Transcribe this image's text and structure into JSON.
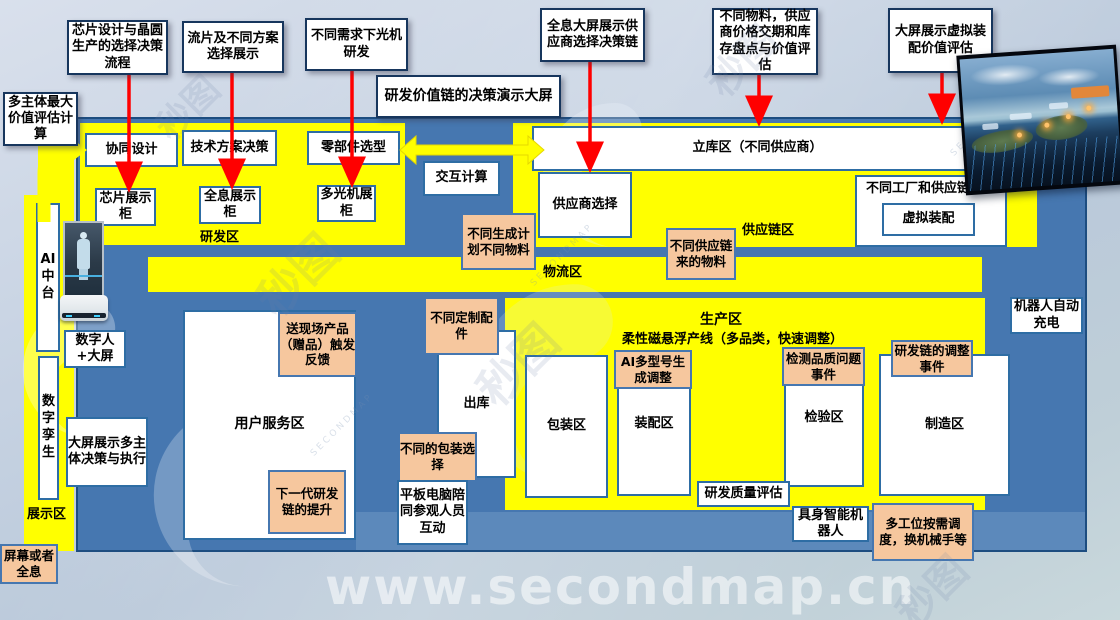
{
  "labels": {
    "callout_chip": "芯片设计与晶圆生产的选择决策流程",
    "callout_tapeout": "流片及不同方案选择展示",
    "callout_optical": "不同需求下光机研发",
    "callout_holo": "全息大屏展示供应商选择决策链",
    "callout_materials": "不同物料，供应商价格交期和库存盘点与价值评估",
    "callout_virtual": "大屏展示虚拟装配价值评估",
    "callout_multi": "多主体最大价值评估计算",
    "banner": "研发价值链的决策演示大屏",
    "collab": "协同设计",
    "tech": "技术方案决策",
    "parts": "零部件选型",
    "interact": "交互计算",
    "chip_cab": "芯片展示柜",
    "holo_cab": "全息展示柜",
    "optical_cab": "多光机展柜",
    "warehouse": "立库区（不同供应商）",
    "supplier_sel": "供应商选择",
    "factory_integration": "不同工厂和供应链整合",
    "virtual_asm": "虚拟装配",
    "zone_rd": "研发区",
    "zone_supply": "供应链区",
    "zone_logistics": "物流区",
    "zone_prod": "生产区",
    "prod_line": "柔性磁悬浮产线（多品类，快速调整）",
    "gen_plan": "不同生成计划不同物料",
    "supply_materials": "不同供应链来的物料",
    "robot_charge": "机器人自动充电",
    "gift": "送现场产品（赠品）触发反馈",
    "custom_parts": "不同定制配件",
    "user_zone": "用户服务区",
    "outbound": "出库",
    "packing_zone": "包装区",
    "asm_zone": "装配区",
    "ai_model": "AI多型号生成调整",
    "inspect_zone": "检验区",
    "quality_event": "检测品质问题事件",
    "mfg_zone": "制造区",
    "rd_adjust": "研发链的调整事件",
    "pack_choice": "不同的包装选择",
    "next_gen": "下一代研发链的提升",
    "tablet": "平板电脑陪同参观人员互动",
    "rd_quality": "研发质量评估",
    "embodied": "具身智能机器人",
    "multi_station": "多工位按需调度，换机械手等",
    "ai_platform": "AI中台",
    "digital_human": "数字人+大屏",
    "digital_twin": "数字孪生",
    "big_screen": "大屏展示多主体决策与执行",
    "zone_display": "展示区",
    "naked_eye": "屏幕或者全息",
    "watermark_url": "www.secondmap.cn",
    "watermark_logo": "秒图",
    "watermark_name": "SECONDMAP"
  },
  "colors": {
    "zone_yellow": "#ffff00",
    "floor_blue": "#4677b0",
    "note_orange": "#f6c79e",
    "arrow_red": "#ff0000",
    "callout_border": "#17365d",
    "box_border": "#2e6da4"
  }
}
